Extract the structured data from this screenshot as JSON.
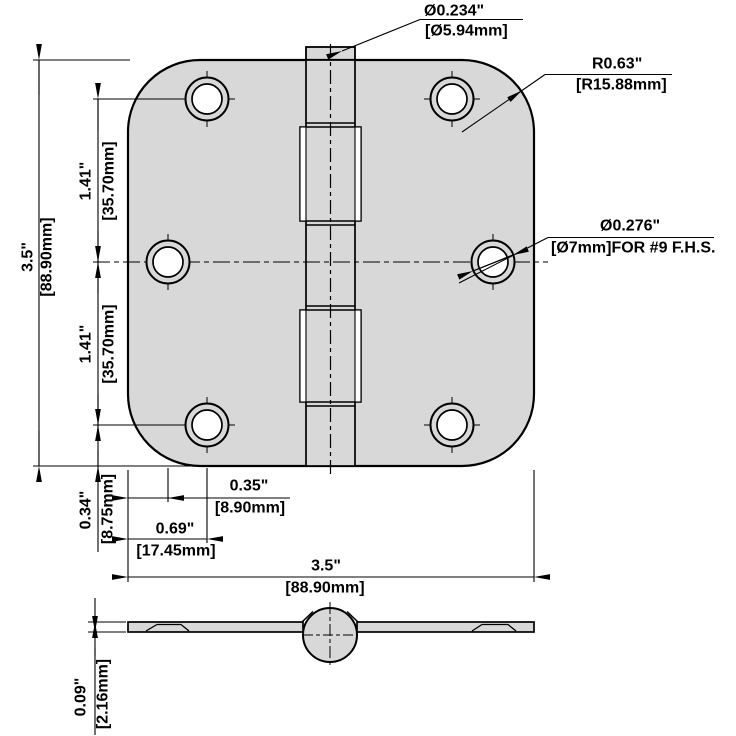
{
  "drawing": {
    "type": "technical-drawing-door-hinge",
    "callouts": {
      "pin": {
        "primary": "Ø0.234\"",
        "secondary": "[Ø5.94mm]"
      },
      "radius": {
        "primary": "R0.63\"",
        "secondary": "[R15.88mm]"
      },
      "hole": {
        "primary": "Ø0.276\"",
        "secondary": "[Ø7mm]FOR #9 F.H.S."
      }
    },
    "dims": {
      "height": {
        "primary": "3.5\"",
        "secondary": "[88.90mm]"
      },
      "spacing_top": {
        "primary": "1.41\"",
        "secondary": "[35.70mm]"
      },
      "spacing_bottom": {
        "primary": "1.41\"",
        "secondary": "[35.70mm]"
      },
      "edge_offset_corner": {
        "primary": "0.34\"",
        "secondary": "[8.75mm]"
      },
      "edge_offset_middle": {
        "primary": "0.35\"",
        "secondary": "[8.90mm]"
      },
      "side_offset_corner": {
        "primary": "0.69\"",
        "secondary": "[17.45mm]"
      },
      "width": {
        "primary": "3.5\"",
        "secondary": "[88.90mm]"
      },
      "thickness": {
        "primary": "0.09\"",
        "secondary": "[2.16mm]"
      }
    },
    "colors": {
      "plate_fill": "#d8d8d8",
      "line": "#000000",
      "background": "#ffffff"
    }
  }
}
